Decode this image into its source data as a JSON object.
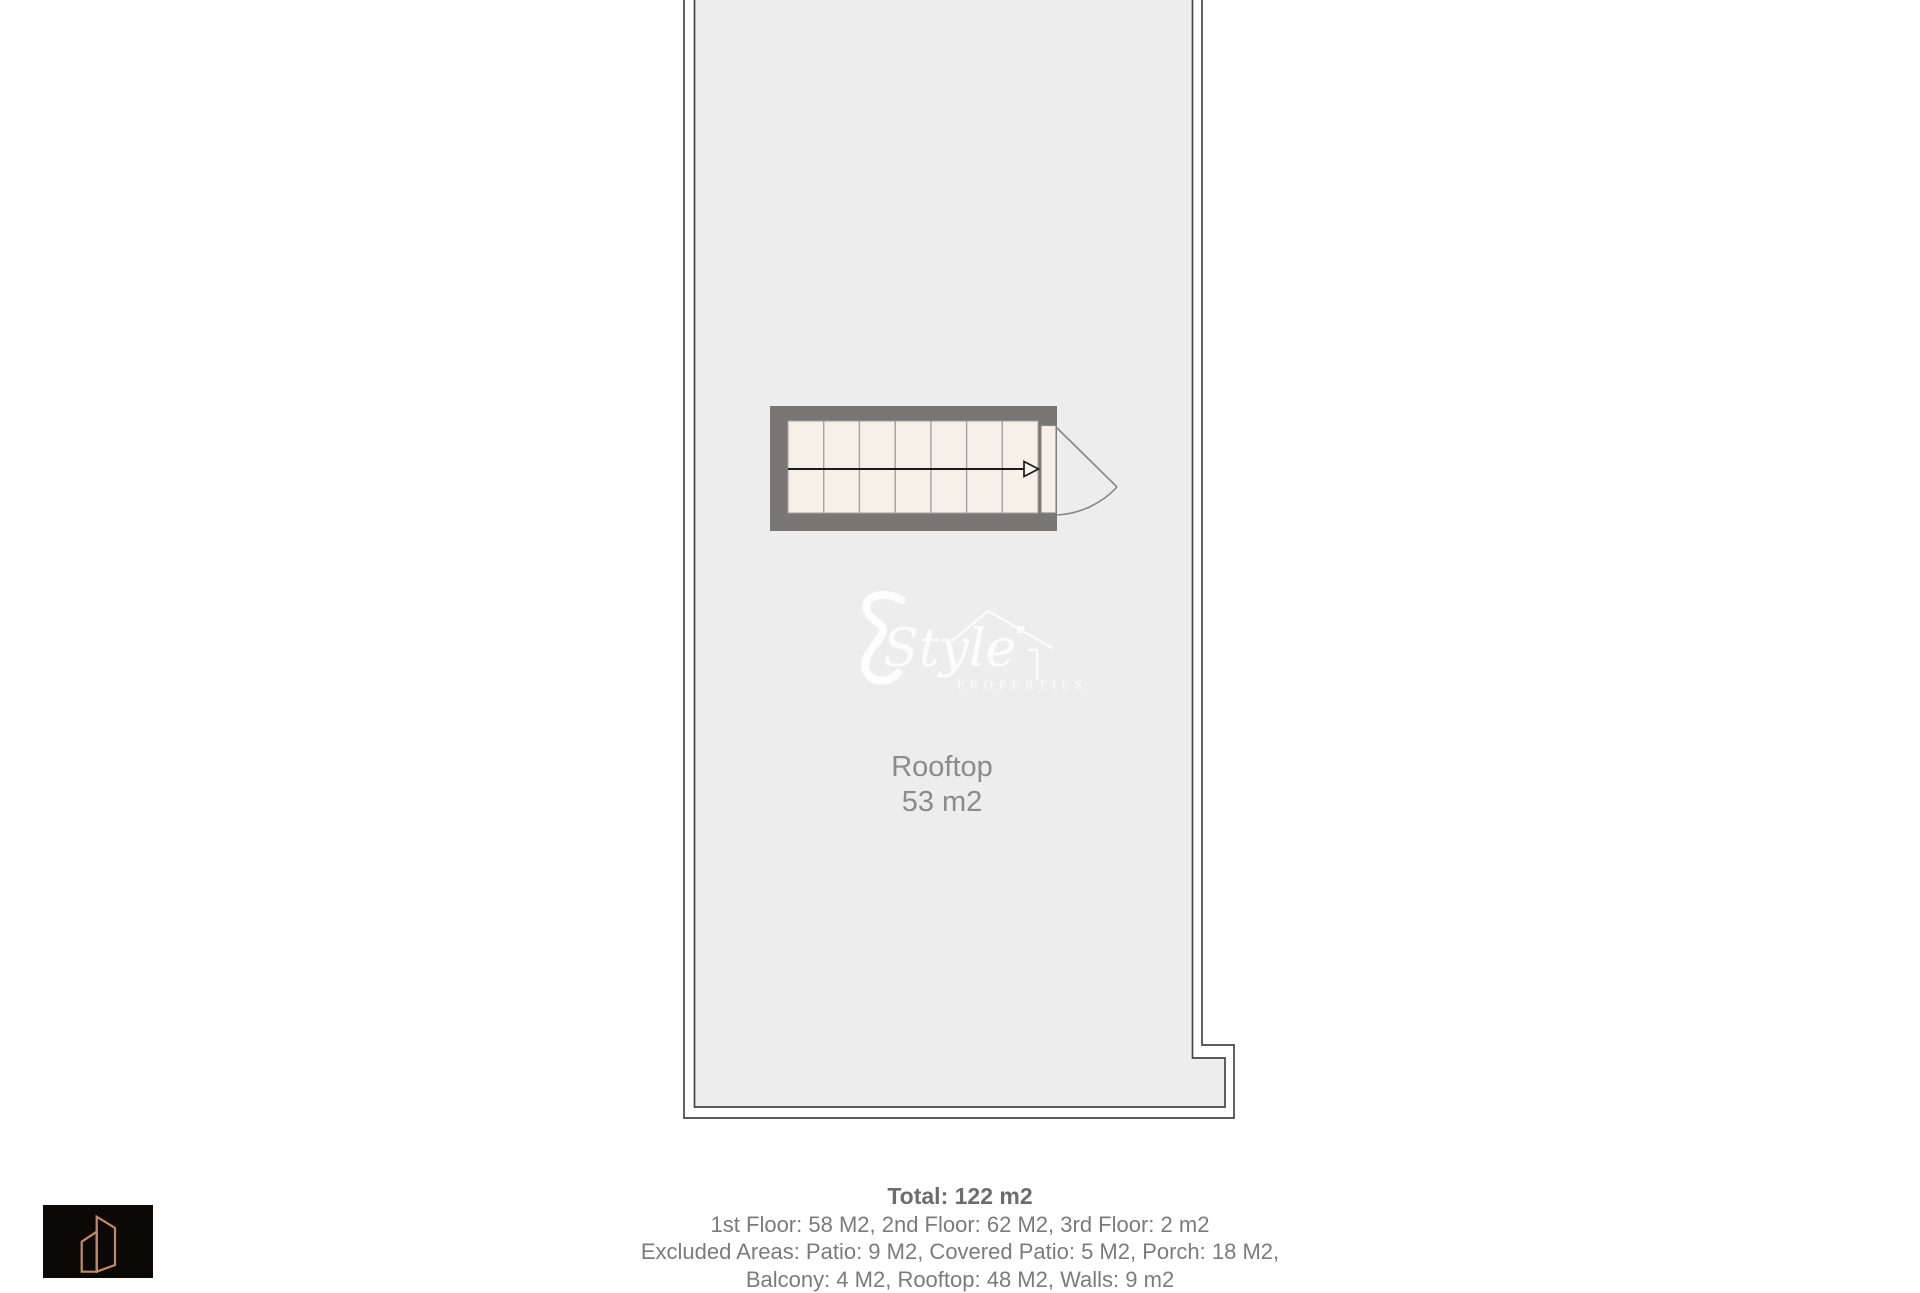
{
  "colors": {
    "plan_fill": "#ededed",
    "wall_gray": "#787775",
    "stair_fill": "#f7f0e9",
    "outline_dark": "#464646",
    "tread_line": "#a6a19d",
    "arrow_black": "#1b1b1b",
    "door_gray": "#868686",
    "label_gray": "#8b8b8b",
    "summary_gray": "#7b7b7b",
    "summary_bold_gray": "#6d6d6d",
    "watermark_white": "#ffffff",
    "logo_bg": "#0b0907",
    "logo_bronze": "#c58a5f"
  },
  "floor_plan": {
    "room_label": "Rooftop",
    "room_area": "53 m2"
  },
  "watermark": {
    "script_word": "Style",
    "caps_word": "PROPERTIES"
  },
  "summary": {
    "total": "Total: 122 m2",
    "floors": "1st Floor: 58 M2, 2nd Floor: 62 M2, 3rd Floor: 2 m2",
    "excluded_line1": "Excluded Areas: Patio: 9 M2, Covered Patio: 5 M2, Porch: 18 M2,",
    "excluded_line2": "Balcony: 4 M2, Rooftop: 48 M2, Walls: 9 m2"
  }
}
